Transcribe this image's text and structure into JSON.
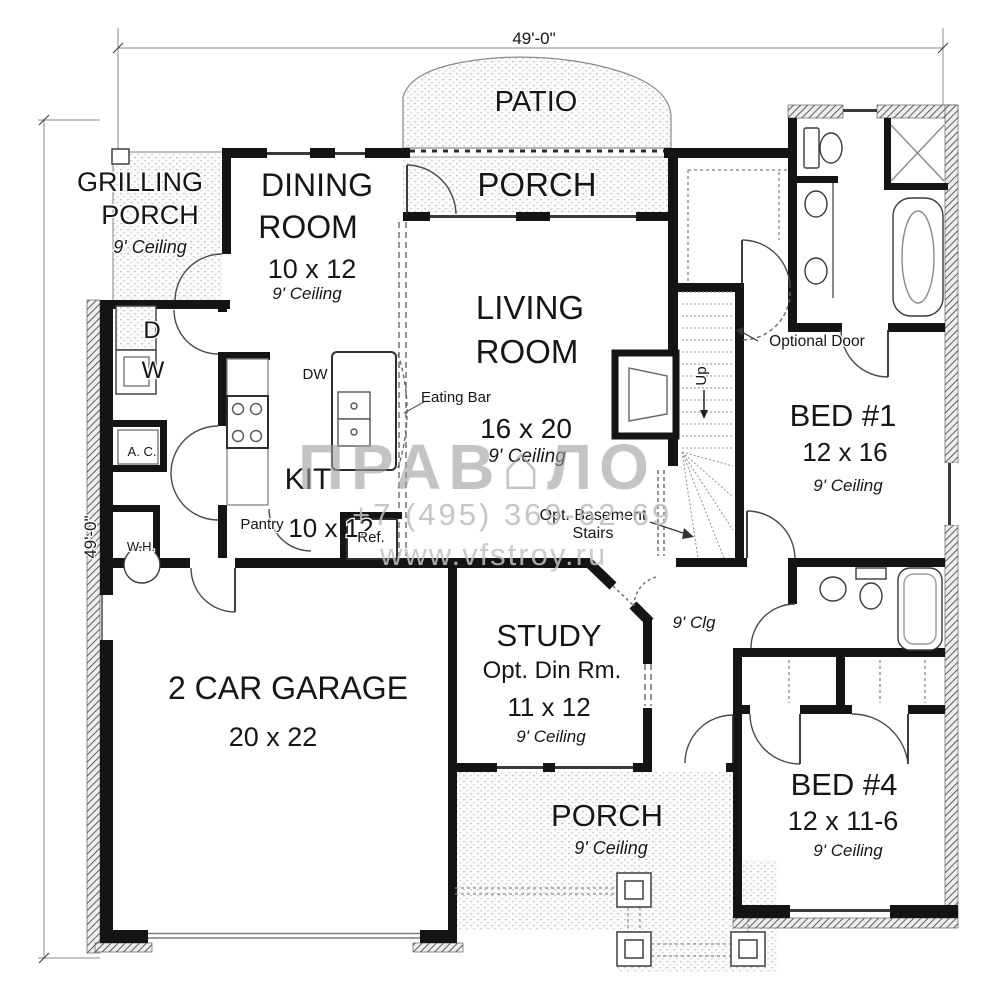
{
  "dimensions": {
    "top": "49'-0\"",
    "left": "49'-0\""
  },
  "rooms": {
    "patio": {
      "name": "PATIO"
    },
    "rear_porch": {
      "name": "PORCH"
    },
    "grilling_porch": {
      "line1": "GRILLING",
      "line2": "PORCH",
      "ceiling": "9' Ceiling"
    },
    "dining": {
      "line1": "DINING",
      "line2": "ROOM",
      "size": "10 x 12",
      "ceiling": "9' Ceiling"
    },
    "living": {
      "line1": "LIVING",
      "line2": "ROOM",
      "size": "16 x 20",
      "ceiling": "9' Ceiling"
    },
    "kitchen": {
      "name": "KIT",
      "size": "10 x 12"
    },
    "garage": {
      "name": "2 CAR GARAGE",
      "size": "20 x 22"
    },
    "study": {
      "name": "STUDY",
      "alt_name": "Opt. Din Rm.",
      "size": "11 x 12",
      "ceiling": "9' Ceiling"
    },
    "front_porch": {
      "name": "PORCH",
      "ceiling": "9' Ceiling"
    },
    "bed1": {
      "name": "BED #1",
      "size": "12 x 16",
      "ceiling": "9' Ceiling"
    },
    "bed4": {
      "name": "BED #4",
      "size": "12 x 11-6",
      "ceiling": "9' Ceiling"
    }
  },
  "fixtures": {
    "dryer": "D",
    "washer": "W",
    "ac": "A. C.",
    "water_heater": "W.H.",
    "dishwasher": "DW",
    "pantry": "Pantry",
    "fridge": "Ref.",
    "eating_bar": "Eating Bar"
  },
  "stairs": {
    "up": "Up",
    "opt_basement_line1": "Opt. Basement",
    "opt_basement_line2": "Stairs"
  },
  "notes": {
    "optional_door": "Optional Door",
    "hall_ceiling": "9' Clg"
  },
  "watermark": {
    "brand_left": "ПРАВ",
    "brand_glyph": "⌂",
    "brand_right": "ЛО",
    "phone": "+7 (495) 369-62-69",
    "site": "www.vfstroy.ru"
  },
  "colors": {
    "wall": "#141414",
    "watermark": "#9e9e9e",
    "paper": "#ffffff"
  }
}
